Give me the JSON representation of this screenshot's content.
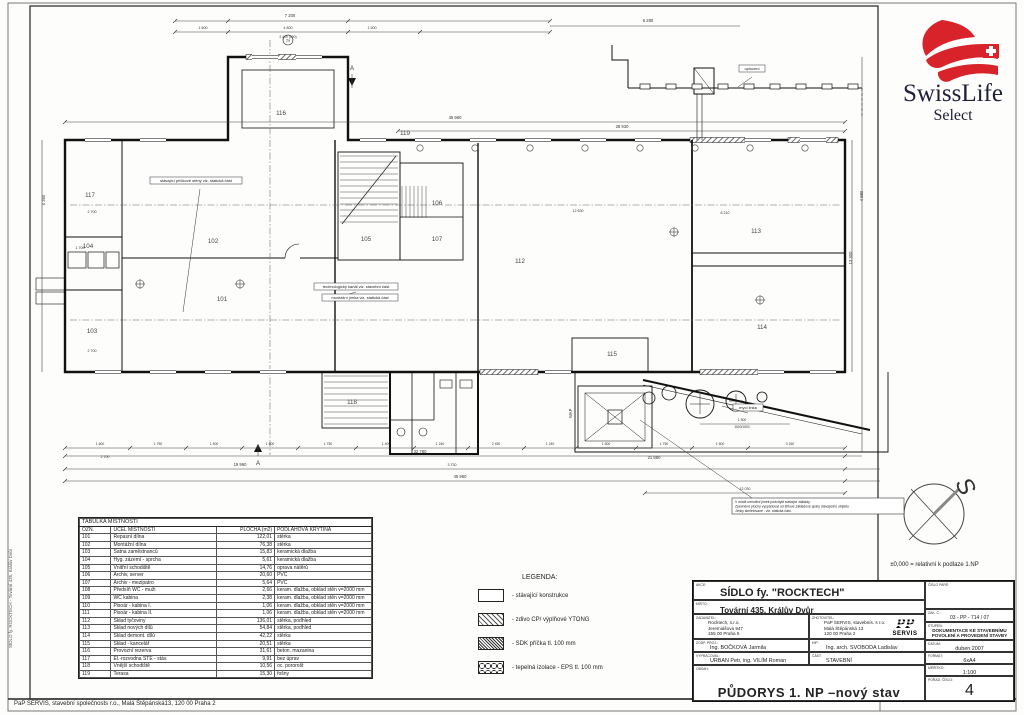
{
  "page": {
    "footer": "PaP SERVIS,  stavební společnosts r.o., Malá Štěpánská13, 120 00 Praha 2",
    "side_label": "SÍDLO fy. ROCKTECH  - Tovární 435, Králův Dvůr"
  },
  "logo": {
    "brand": "SwissLife",
    "sub": "Select",
    "red": "#d8232a",
    "dark": "#20203a"
  },
  "plan": {
    "compass": {
      "label": "S",
      "note": "±0,000 = relativní k podlaze 1.NP"
    },
    "rooms": [
      {
        "id": "101",
        "x": 222,
        "y": 301
      },
      {
        "id": "102",
        "x": 213,
        "y": 243
      },
      {
        "id": "103",
        "x": 92,
        "y": 333
      },
      {
        "id": "104",
        "x": 88,
        "y": 248
      },
      {
        "id": "105",
        "x": 366,
        "y": 241
      },
      {
        "id": "106",
        "x": 437,
        "y": 205
      },
      {
        "id": "107",
        "x": 437,
        "y": 241
      },
      {
        "id": "112",
        "x": 520,
        "y": 263
      },
      {
        "id": "113",
        "x": 756,
        "y": 233
      },
      {
        "id": "114",
        "x": 762,
        "y": 329
      },
      {
        "id": "115",
        "x": 612,
        "y": 356
      },
      {
        "id": "116",
        "x": 281,
        "y": 115
      },
      {
        "id": "117",
        "x": 90,
        "y": 197
      },
      {
        "id": "118",
        "x": 352,
        "y": 404
      },
      {
        "id": "119",
        "x": 405,
        "y": 135
      }
    ],
    "dimensions": [
      {
        "t": "7 200",
        "x": 290,
        "y": 17
      },
      {
        "t": "1 600",
        "x": 203,
        "y": 29,
        "s": 3.6
      },
      {
        "t": "4 800",
        "x": 288,
        "y": 29,
        "s": 3.6
      },
      {
        "t": "1 500",
        "x": 372,
        "y": 29,
        "s": 3.6
      },
      {
        "t": "2 400 (500)",
        "x": 288,
        "y": 38,
        "s": 3.4
      },
      {
        "t": "6 280",
        "x": 648,
        "y": 22
      },
      {
        "t": "45 960",
        "x": 455,
        "y": 119
      },
      {
        "t": "28 930",
        "x": 622,
        "y": 128
      },
      {
        "t": "12 630",
        "x": 578,
        "y": 212,
        "s": 3.6
      },
      {
        "t": "8 210",
        "x": 725,
        "y": 214,
        "s": 3.6
      },
      {
        "t": "2 700",
        "x": 92,
        "y": 213,
        "s": 3.6
      },
      {
        "t": "1 700",
        "x": 80,
        "y": 249,
        "s": 3.6
      },
      {
        "t": "2 700",
        "x": 92,
        "y": 352,
        "s": 3.6
      },
      {
        "t": "13 300",
        "x": 852,
        "y": 258,
        "r": 1
      },
      {
        "t": "4 880",
        "x": 863,
        "y": 196,
        "r": 1
      },
      {
        "t": "4 360",
        "x": 45,
        "y": 200,
        "r": 1
      },
      {
        "t": "1 600",
        "x": 100,
        "y": 445,
        "s": 3.4
      },
      {
        "t": "1 750",
        "x": 158,
        "y": 445,
        "s": 3.4
      },
      {
        "t": "1 400",
        "x": 214,
        "y": 445,
        "s": 3.4
      },
      {
        "t": "1 600",
        "x": 270,
        "y": 445,
        "s": 3.4
      },
      {
        "t": "1 750",
        "x": 328,
        "y": 445,
        "s": 3.4
      },
      {
        "t": "1 400",
        "x": 386,
        "y": 445,
        "s": 3.4
      },
      {
        "t": "1 240",
        "x": 440,
        "y": 445,
        "s": 3.4
      },
      {
        "t": "2 450",
        "x": 496,
        "y": 445,
        "s": 3.4
      },
      {
        "t": "1 240",
        "x": 550,
        "y": 445,
        "s": 3.4
      },
      {
        "t": "1 600",
        "x": 606,
        "y": 445,
        "s": 3.4
      },
      {
        "t": "1 750",
        "x": 664,
        "y": 445,
        "s": 3.4
      },
      {
        "t": "1 600",
        "x": 720,
        "y": 445,
        "s": 3.4
      },
      {
        "t": "3 260",
        "x": 790,
        "y": 445,
        "s": 3.4
      },
      {
        "t": "2 700",
        "x": 105,
        "y": 458,
        "s": 3.6
      },
      {
        "t": "21 880",
        "x": 654,
        "y": 459
      },
      {
        "t": "32 780",
        "x": 420,
        "y": 453
      },
      {
        "t": "19 960",
        "x": 240,
        "y": 466
      },
      {
        "t": "3 730",
        "x": 452,
        "y": 466,
        "s": 3.6
      },
      {
        "t": "45 960",
        "x": 460,
        "y": 478
      },
      {
        "t": "12 030",
        "x": 745,
        "y": 490,
        "s": 3.6
      },
      {
        "t": "1 500",
        "x": 742,
        "y": 421,
        "s": 3.4
      },
      {
        "t": "1600/1600",
        "x": 742,
        "y": 428,
        "s": 3.2
      },
      {
        "t": "A",
        "x": 352,
        "y": 70,
        "s": 6
      },
      {
        "t": "A",
        "x": 258,
        "y": 465,
        "s": 6
      },
      {
        "t": "2a",
        "x": 288,
        "y": 41.5,
        "s": 3.6
      }
    ],
    "annotations": [
      {
        "t": "oplocení",
        "x": 752,
        "y": 70,
        "w": 26,
        "leader": [
          752,
          77,
          738,
          87
        ]
      },
      {
        "t": "stávající příčkové stěny viz. statická část",
        "x": 196,
        "y": 182,
        "w": 92,
        "leader": [
          200,
          189,
          183,
          312
        ]
      },
      {
        "t": "technologický kanál viz. stavební část",
        "x": 356,
        "y": 288,
        "w": 84,
        "leader": [
          356,
          292,
          336,
          298
        ]
      },
      {
        "t": "montážní jímka viz. statická část",
        "x": 360,
        "y": 299,
        "w": 76
      },
      {
        "t": "mycí linka",
        "x": 748,
        "y": 409,
        "w": 30,
        "leader": [
          748,
          413,
          722,
          406
        ]
      }
    ],
    "wap_label": "WAP",
    "note": {
      "x": 732,
      "y": 498,
      "w": 172,
      "lines": [
        "V místě umístění jímek podchytit stávající základy.",
        "Zpevněné plochy vyspádovat od štítové základové spáry stávajícího objektu",
        "Jímky skeletované - viz. statická část."
      ]
    }
  },
  "room_table": {
    "title": "TABULKA MÍSTNOSTÍ",
    "headers": [
      "OZN.",
      "ÚČEL MÍSTNOSTI",
      "PLOCHA (m2)",
      "PODLAHOVÁ KRYTINA"
    ],
    "rows": [
      [
        "101",
        "Repasní dílna",
        "122,01",
        "stěrka"
      ],
      [
        "102",
        "Montážní dílna",
        "76,38",
        "stěrka"
      ],
      [
        "103",
        "Šatna zaměstnanců",
        "15,83",
        "keramická dlažba"
      ],
      [
        "104",
        "Hyg. zázemí - sprcha",
        "5,61",
        "keramická dlažba"
      ],
      [
        "105",
        "Vnitřní schodiště",
        "14,76",
        "oprava nátěrů"
      ],
      [
        "106",
        "Archiv, server",
        "20,60",
        "PVC"
      ],
      [
        "107",
        "Archiv - mezipatro",
        "5,64",
        "PVC"
      ],
      [
        "108",
        "Předsíň WC - muži",
        "2,66",
        "keram. dlažba, obklad stěn v=2000 mm"
      ],
      [
        "109",
        "WC kabina",
        "2,38",
        "keram. dlažba, obklad stěn v=2000 mm"
      ],
      [
        "110",
        "Pisoár - kabina I.",
        "1,06",
        "keram. dlažba, obklad stěn v=2000 mm"
      ],
      [
        "111",
        "Pisoár - kabina II.",
        "1,06",
        "keram. dlažba, obklad stěn v=2000 mm"
      ],
      [
        "112",
        "Sklad tyčoviny",
        "136,01",
        "stěrka, podhled"
      ],
      [
        "113",
        "Sklad nových dílů",
        "54,84",
        "stěrka, podhled"
      ],
      [
        "114",
        "Sklad demont. dílů",
        "42,22",
        "stěrka"
      ],
      [
        "115",
        "Sklad - kancelář",
        "20,51",
        "stěrka"
      ],
      [
        "116",
        "Provozní rezerva",
        "31,61",
        "beton. mazanina"
      ],
      [
        "117",
        "El.-rozvodna STE - stáv.",
        "9,91",
        "bez úprav"
      ],
      [
        "118",
        "Vnější schodiště",
        "10,56",
        "oc. pororošt"
      ],
      [
        "119",
        "Terasa",
        "15,30",
        "fošny"
      ]
    ]
  },
  "legend": {
    "title": "LEGENDA:",
    "items": [
      {
        "swatch": "empty",
        "label": "- stávající konstrukce"
      },
      {
        "swatch": "diag",
        "label": "- zdivo CP/ výplňové YTONG"
      },
      {
        "swatch": "dense",
        "label": "- SDK příčka tl. 100 mm"
      },
      {
        "swatch": "wave",
        "label": "- tepelná izolace - EPS tl. 100 mm"
      }
    ]
  },
  "title_block": {
    "akce_label": "AKCE:",
    "akce": "SÍDLO fy. \"ROCKTECH\"",
    "misto_label": "MÍSTO:",
    "misto": "Tovární 435, Králův Dvůr",
    "zadavatel_label": "ZADAVATEL:",
    "zadavatel": [
      "Rocktech, s.r.o.",
      "Jeremiášova 947",
      "155 00 Praha 5"
    ],
    "zhotovitel_label": "ZHOTOVITEL:",
    "zhotovitel": [
      "PaP SERVIS, stavebnís. s r.o.",
      "Malá Štěpánská 13",
      "120 00 Praha 2"
    ],
    "pap_logo": {
      "pp": "PP",
      "servis": "SERVIS"
    },
    "zodp_label": "ZODP. PROJ.:",
    "zodp": "Ing. BOČKOVÁ Jarmila",
    "hip_label": "HIP:",
    "hip": "Ing. arch. SVOBODA Ladislav",
    "vypracoval_label": "VYPRACOVAL:",
    "vypracoval": "URBAN Petr, ing. VILÍM Roman",
    "cast_label": "ČÁST:",
    "cast": "STAVEBNÍ",
    "obsah_label": "OBSAH:",
    "title": "PŮDORYS  1. NP  –nový stav",
    "cislo_pare_label": "ČÍSLO PARÉ:",
    "zak_label": "ZAK. Č.:",
    "zak": "03 - PP - 714 / 07",
    "stupen_label": "STUPEŇ:",
    "stupen": "DOKUMENTACE KE STAVEBNÍMU POVOLENÍ A PROVEDENÍ STAVBY",
    "datum_label": "DATUM:",
    "datum": "duben 2007",
    "format_label": "FORMÁT:",
    "format": "6xA4",
    "meritko_label": "MĚŘÍTKO:",
    "meritko": "1:100",
    "porad_label": "POŘAD. ČÍSLO:",
    "porad": "4"
  }
}
